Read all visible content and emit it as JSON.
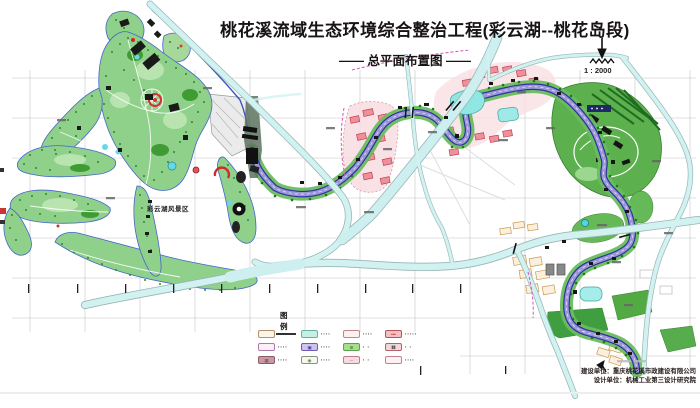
{
  "header": {
    "title": "桃花溪流域生态环境综合整治工程(彩云湖--桃花岛段)",
    "subtitle": "—— 总平面布置图 ——",
    "scale_label": "1 : 2000"
  },
  "map": {
    "area_label": "彩云湖风景区",
    "features": [
      "park",
      "lake",
      "creek",
      "roads",
      "grid",
      "residential-zones",
      "orchard-hill",
      "ponds",
      "dam"
    ]
  },
  "legend": {
    "title": "图 例",
    "items": [
      {
        "label": "▪▪▪▪",
        "glyph": "",
        "swatch_style": "background:#fdf4e8;border:1px solid #b5906a;"
      },
      {
        "label": "▪▪▪▪",
        "glyph": "",
        "swatch_style": "background:#c2f0e6;border:1px solid #6fae9f;"
      },
      {
        "label": "▪▪▪▪",
        "glyph": "",
        "swatch_style": "background:#fdf0f1;border:1px solid #c4848e;"
      },
      {
        "label": "▪▪▪▪▪",
        "glyph": "•••",
        "swatch_style": "background:#f3bfc1;border:1px solid #b25656;color:#cc2222;"
      },
      {
        "label": "▪▪▪▪",
        "glyph": "",
        "swatch_style": "background:#fbf0f8;border:1px solid #b279a8;"
      },
      {
        "label": "▪▪▪▪",
        "glyph": "▣",
        "swatch_style": "background:#cfc2ee;border:1px solid #6f5cb8;color:#3c2f9a;"
      },
      {
        "label": "▪  ▪",
        "glyph": "≋",
        "swatch_style": "background:#a6dd8f;border:1px solid #57a24b;color:#2e7f2e;"
      },
      {
        "label": "▪  ▪",
        "glyph": "⦀⦀",
        "swatch_style": "background:#f2d6d8;border:1px solid #bb5f6d;color:#444444;"
      },
      {
        "label": "▪▪▪▪",
        "glyph": "▦",
        "swatch_style": "background:#c59aa4;border:1px solid #8d5a66;color:#7d4650;"
      },
      {
        "label": "▪▪▪▪",
        "glyph": "◉",
        "swatch_style": "background:#f7f7ee;border:1px solid #8f9180;color:#3f8f3f;"
      },
      {
        "label": "▪  ▪",
        "glyph": "─",
        "swatch_style": "background:#f4dce0;border:1px solid #bd7d8d;color:#c0607f;"
      },
      {
        "label": "▪▪▪▪",
        "glyph": "",
        "swatch_style": "background:#fdf2f3;border:1px solid #c2808d;"
      }
    ]
  },
  "credits": {
    "line1": "建设单位：重庆桃花溪市政建设有限公司",
    "line2": "设计单位：机械工业第三设计研究院"
  },
  "colors": {
    "road_fill": "#d2f1f1",
    "road_casing": "#96b6b6",
    "creek_fill": "#9a97d8",
    "creek_edge": "#31319a",
    "park_green": "#8fd08a",
    "bank_green": "#69bd5e",
    "hill_green": "#5cb04e",
    "tree_dark_green": "#2c8a2c",
    "pink_zone": "#f8dde2",
    "pink_block": "#ee8f9b",
    "pool_cyan": "#8fe6e2",
    "grid_gray": "#c4c4c4",
    "building_black": "#161616",
    "accent_red": "#cf2b2b"
  }
}
